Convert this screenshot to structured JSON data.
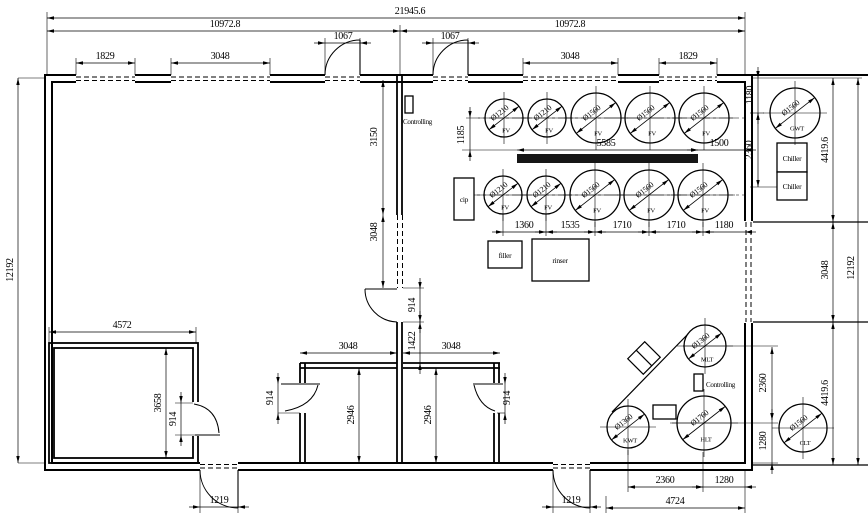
{
  "drawing": {
    "type": "floor-plan",
    "units_note": "mm dimensions as printed on drawing",
    "dimensions": [
      {
        "value": "21945.6",
        "x": 410,
        "y": 14,
        "orient": "h"
      },
      {
        "value": "10972.8",
        "x": 225,
        "y": 27,
        "orient": "h"
      },
      {
        "value": "10972.8",
        "x": 570,
        "y": 27,
        "orient": "h"
      },
      {
        "value": "1829",
        "x": 105,
        "y": 59,
        "orient": "h"
      },
      {
        "value": "3048",
        "x": 220,
        "y": 59,
        "orient": "h"
      },
      {
        "value": "1067",
        "x": 343,
        "y": 39,
        "orient": "h"
      },
      {
        "value": "1067",
        "x": 450,
        "y": 39,
        "orient": "h"
      },
      {
        "value": "3048",
        "x": 570,
        "y": 59,
        "orient": "h"
      },
      {
        "value": "1829",
        "x": 688,
        "y": 59,
        "orient": "h"
      },
      {
        "value": "5585",
        "x": 606,
        "y": 146,
        "orient": "h"
      },
      {
        "value": "1500",
        "x": 719,
        "y": 146,
        "orient": "h"
      },
      {
        "value": "1360",
        "x": 524,
        "y": 228,
        "orient": "h"
      },
      {
        "value": "1535",
        "x": 570,
        "y": 228,
        "orient": "h"
      },
      {
        "value": "1710",
        "x": 622,
        "y": 228,
        "orient": "h"
      },
      {
        "value": "1710",
        "x": 676,
        "y": 228,
        "orient": "h"
      },
      {
        "value": "1180",
        "x": 724,
        "y": 228,
        "orient": "h"
      },
      {
        "value": "4572",
        "x": 122,
        "y": 328,
        "orient": "h"
      },
      {
        "value": "3048",
        "x": 348,
        "y": 349,
        "orient": "h"
      },
      {
        "value": "3048",
        "x": 451,
        "y": 349,
        "orient": "h"
      },
      {
        "value": "1219",
        "x": 219,
        "y": 503,
        "orient": "h"
      },
      {
        "value": "1219",
        "x": 571,
        "y": 503,
        "orient": "h"
      },
      {
        "value": "2360",
        "x": 665,
        "y": 483,
        "orient": "h"
      },
      {
        "value": "1280",
        "x": 724,
        "y": 483,
        "orient": "h"
      },
      {
        "value": "4724",
        "x": 675,
        "y": 504,
        "orient": "h"
      },
      {
        "value": "12192",
        "x": 13,
        "y": 270,
        "orient": "v"
      },
      {
        "value": "3150",
        "x": 377,
        "y": 137,
        "orient": "v"
      },
      {
        "value": "3048",
        "x": 377,
        "y": 232,
        "orient": "v"
      },
      {
        "value": "914",
        "x": 415,
        "y": 305,
        "orient": "v"
      },
      {
        "value": "1422",
        "x": 415,
        "y": 341,
        "orient": "v"
      },
      {
        "value": "914",
        "x": 273,
        "y": 398,
        "orient": "v"
      },
      {
        "value": "914",
        "x": 510,
        "y": 398,
        "orient": "v"
      },
      {
        "value": "2946",
        "x": 354,
        "y": 415,
        "orient": "v"
      },
      {
        "value": "2946",
        "x": 431,
        "y": 415,
        "orient": "v"
      },
      {
        "value": "3658",
        "x": 161,
        "y": 403,
        "orient": "v"
      },
      {
        "value": "914",
        "x": 176,
        "y": 419,
        "orient": "v"
      },
      {
        "value": "1185",
        "x": 464,
        "y": 135,
        "orient": "v"
      },
      {
        "value": "1180",
        "x": 753,
        "y": 95,
        "orient": "v"
      },
      {
        "value": "2360",
        "x": 752,
        "y": 150,
        "orient": "v"
      },
      {
        "value": "4419.6",
        "x": 828,
        "y": 150,
        "orient": "v"
      },
      {
        "value": "3048",
        "x": 828,
        "y": 270,
        "orient": "v"
      },
      {
        "value": "4419.6",
        "x": 828,
        "y": 393,
        "orient": "v"
      },
      {
        "value": "2360",
        "x": 766,
        "y": 383,
        "orient": "v"
      },
      {
        "value": "1280",
        "x": 766,
        "y": 441,
        "orient": "v"
      },
      {
        "value": "12192",
        "x": 854,
        "y": 268,
        "orient": "v"
      }
    ],
    "tanks": [
      {
        "diameter": "Ø1210",
        "name": "FV",
        "cx": 504,
        "cy": 118,
        "r": 19
      },
      {
        "diameter": "Ø1210",
        "name": "FV",
        "cx": 547,
        "cy": 118,
        "r": 19
      },
      {
        "diameter": "Ø1560",
        "name": "FV",
        "cx": 596,
        "cy": 118,
        "r": 25
      },
      {
        "diameter": "Ø1560",
        "name": "FV",
        "cx": 650,
        "cy": 118,
        "r": 25
      },
      {
        "diameter": "Ø1560",
        "name": "FV",
        "cx": 704,
        "cy": 118,
        "r": 25
      },
      {
        "diameter": "Ø1210",
        "name": "FV",
        "cx": 503,
        "cy": 195,
        "r": 19
      },
      {
        "diameter": "Ø1210",
        "name": "FV",
        "cx": 546,
        "cy": 195,
        "r": 19
      },
      {
        "diameter": "Ø1560",
        "name": "FV",
        "cx": 595,
        "cy": 195,
        "r": 25
      },
      {
        "diameter": "Ø1560",
        "name": "FV",
        "cx": 649,
        "cy": 195,
        "r": 25
      },
      {
        "diameter": "Ø1560",
        "name": "FV",
        "cx": 703,
        "cy": 195,
        "r": 25
      },
      {
        "diameter": "Ø1560",
        "name": "GWT",
        "cx": 795,
        "cy": 113,
        "r": 25
      },
      {
        "diameter": "Ø1360",
        "name": "MLT",
        "cx": 705,
        "cy": 346,
        "r": 21
      },
      {
        "diameter": "Ø1360",
        "name": "KWT",
        "cx": 628,
        "cy": 427,
        "r": 21
      },
      {
        "diameter": "Ø1760",
        "name": "HLT",
        "cx": 704,
        "cy": 423,
        "r": 27
      },
      {
        "diameter": "Ø1560",
        "name": "CLT",
        "cx": 803,
        "cy": 428,
        "r": 24
      }
    ],
    "equipment": [
      {
        "label": "Controlling",
        "x": 405,
        "y": 96,
        "w": 8,
        "h": 17,
        "lx": 403,
        "ly": 124,
        "anchor": "start",
        "fs": 7
      },
      {
        "label": "cip",
        "x": 454,
        "y": 178,
        "w": 20,
        "h": 42,
        "lx": 464,
        "ly": 202,
        "anchor": "middle",
        "fs": 7.5
      },
      {
        "label": "filler",
        "x": 488,
        "y": 241,
        "w": 34,
        "h": 27,
        "lx": 505,
        "ly": 258,
        "anchor": "middle",
        "fs": 7.5
      },
      {
        "label": "rinser",
        "x": 532,
        "y": 239,
        "w": 57,
        "h": 42,
        "lx": 560,
        "ly": 263,
        "anchor": "middle",
        "fs": 7.5
      },
      {
        "label": "Chiller",
        "x": 777,
        "y": 143,
        "w": 30,
        "h": 29,
        "lx": 792,
        "ly": 161,
        "anchor": "middle",
        "fs": 7.5
      },
      {
        "label": "Chiller",
        "x": 777,
        "y": 172,
        "w": 30,
        "h": 28,
        "lx": 792,
        "ly": 189,
        "anchor": "middle",
        "fs": 7.5
      },
      {
        "label": "Controlling",
        "x": 694,
        "y": 374,
        "w": 9,
        "h": 17,
        "lx": 706,
        "ly": 387,
        "anchor": "start",
        "fs": 7
      },
      {
        "label": "",
        "x": 653,
        "y": 405,
        "w": 23,
        "h": 14,
        "lx": 0,
        "ly": 0,
        "anchor": "middle",
        "fs": 7
      }
    ]
  }
}
